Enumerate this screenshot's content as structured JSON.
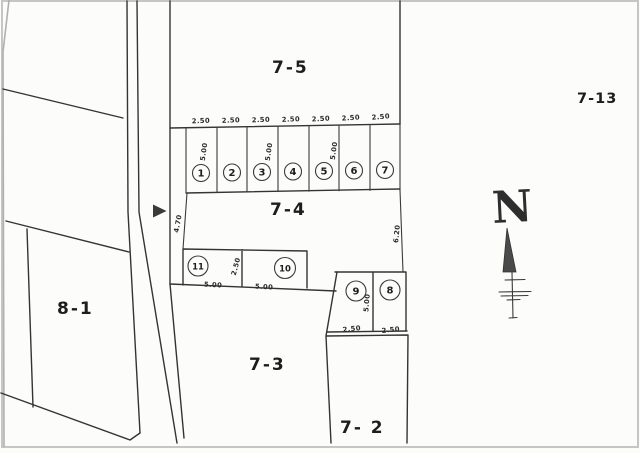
{
  "document": {
    "kind": "scanned cadastral plot plan",
    "colors": {
      "paper": "#fcfcfa",
      "ink": "#343434",
      "scan_border": "#c6c6c6"
    }
  },
  "parcels": {
    "p7_5": "7-5",
    "p7_13": "7-13",
    "p7_4": "7-4",
    "p8_1": "8-1",
    "p7_3": "7-3",
    "p7_2": "7- 2"
  },
  "lots_row": {
    "numbers": [
      "1",
      "2",
      "3",
      "4",
      "5",
      "6",
      "7"
    ],
    "widths": [
      "2.50",
      "2.50",
      "2.50",
      "2.50",
      "2.50",
      "2.50",
      "2.50"
    ],
    "depths": [
      "5.00",
      "5.00",
      "5.00"
    ]
  },
  "lots_mid": {
    "numbers": [
      "11",
      "10"
    ],
    "depth": "2.50",
    "widths": [
      "5.00",
      "5.00"
    ]
  },
  "lots_lower": {
    "numbers": [
      "9",
      "8"
    ],
    "depth": "5.00",
    "widths": [
      "2.50",
      "2.50"
    ]
  },
  "dimensions": {
    "road_frontage": "4.70",
    "east_side": "6.20"
  },
  "compass": {
    "north": "N"
  }
}
